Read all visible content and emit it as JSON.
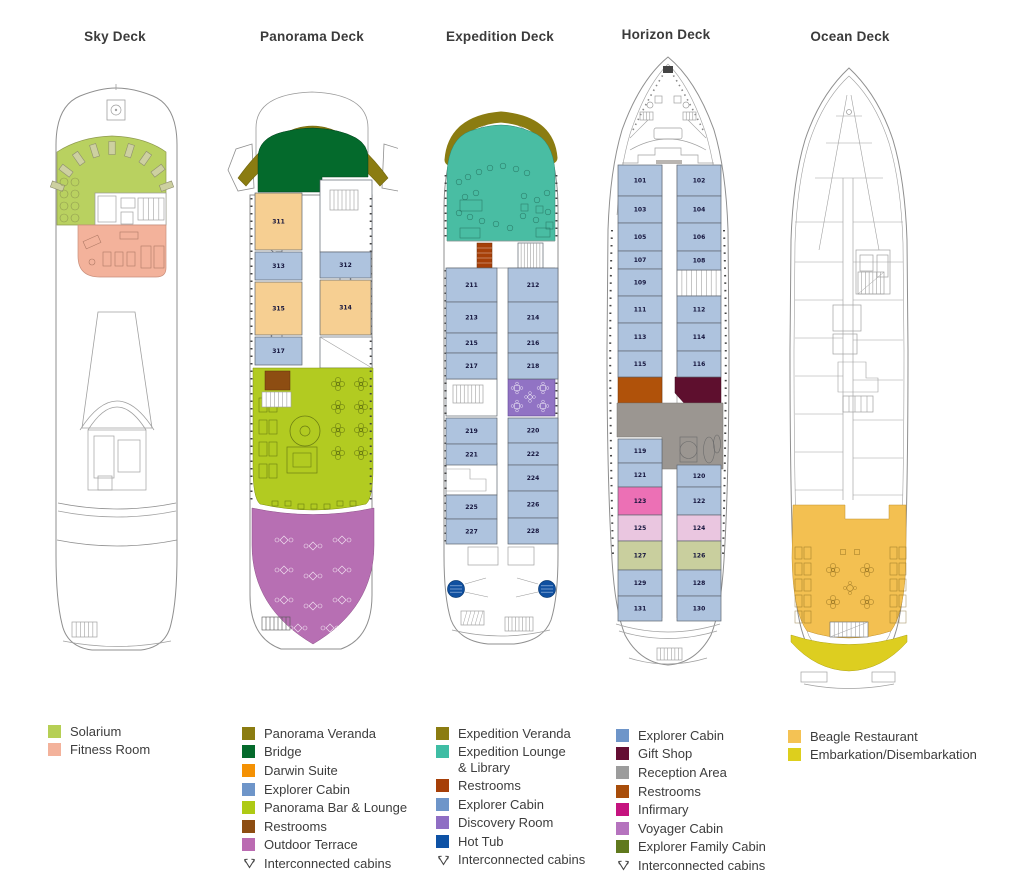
{
  "decks": [
    {
      "id": "sky",
      "title": "Sky Deck",
      "regions": {
        "solarium": "#b9d160",
        "fitness": "#f3b29b",
        "lounger": "#cdd0a0"
      },
      "legend": [
        {
          "label": "Solarium",
          "color": "#b6cf55"
        },
        {
          "label": "Fitness Room",
          "color": "#f3b29b"
        }
      ]
    },
    {
      "id": "panorama",
      "title": "Panorama Deck",
      "regions": {
        "veranda": "#8b7c11",
        "bridge": "#046a2c",
        "bar_lounge": "#b2cb21",
        "terrace": "#b76fb3",
        "restrooms": "#8d4d12"
      },
      "cabins": [
        {
          "number": "311",
          "fill": "#f6cf92"
        },
        {
          "number": "313",
          "fill": "#aec3de"
        },
        {
          "number": "315",
          "fill": "#f6cf92"
        },
        {
          "number": "317",
          "fill": "#aec3de"
        },
        {
          "number": "312",
          "fill": "#aec3de"
        },
        {
          "number": "314",
          "fill": "#f6cf92"
        }
      ],
      "legend": [
        {
          "label": "Panorama Veranda",
          "color": "#8b7c11"
        },
        {
          "label": "Bridge",
          "color": "#046a2c"
        },
        {
          "label": "Darwin Suite",
          "color": "#f49104"
        },
        {
          "label": "Explorer Cabin",
          "color": "#6e95c9"
        },
        {
          "label": "Panorama Bar & Lounge",
          "color": "#aeca14"
        },
        {
          "label": "Restrooms",
          "color": "#8d4d12"
        },
        {
          "label": "Outdoor Terrace",
          "color": "#bb6bb2"
        },
        {
          "label": "Interconnected cabins",
          "icon": "interconnect"
        }
      ]
    },
    {
      "id": "expedition",
      "title": "Expedition Deck",
      "regions": {
        "veranda": "#8b7c11",
        "lounge": "#49bda3",
        "restrooms": "#a63f08",
        "discovery": "#9173c4",
        "hot_tub": "#1050a0"
      },
      "cabins": [
        {
          "number": "211",
          "fill": "#aec3de"
        },
        {
          "number": "213",
          "fill": "#aec3de"
        },
        {
          "number": "215",
          "fill": "#aec3de"
        },
        {
          "number": "217",
          "fill": "#aec3de"
        },
        {
          "number": "219",
          "fill": "#aec3de"
        },
        {
          "number": "221",
          "fill": "#aec3de"
        },
        {
          "number": "225",
          "fill": "#aec3de"
        },
        {
          "number": "227",
          "fill": "#aec3de"
        },
        {
          "number": "212",
          "fill": "#aec3de"
        },
        {
          "number": "214",
          "fill": "#aec3de"
        },
        {
          "number": "216",
          "fill": "#aec3de"
        },
        {
          "number": "218",
          "fill": "#aec3de"
        },
        {
          "number": "220",
          "fill": "#aec3de"
        },
        {
          "number": "222",
          "fill": "#aec3de"
        },
        {
          "number": "224",
          "fill": "#aec3de"
        },
        {
          "number": "226",
          "fill": "#aec3de"
        },
        {
          "number": "228",
          "fill": "#aec3de"
        }
      ],
      "legend": [
        {
          "label": "Expedition Veranda",
          "color": "#8b7c11"
        },
        {
          "label": "Expedition Lounge",
          "label2": "& Library",
          "color": "#3fbda4"
        },
        {
          "label": "Restrooms",
          "color": "#a63f08"
        },
        {
          "label": "Explorer Cabin",
          "color": "#6e95c9"
        },
        {
          "label": "Discovery Room",
          "color": "#8f6ec4"
        },
        {
          "label": "Hot Tub",
          "color": "#0e52a5"
        },
        {
          "label": "Interconnected cabins",
          "icon": "interconnect"
        }
      ]
    },
    {
      "id": "horizon",
      "title": "Horizon Deck",
      "regions": {
        "restrooms": "#b0520a",
        "gift_shop": "#5e0f2e",
        "reception": "#9b9691"
      },
      "cabins": [
        {
          "number": "101",
          "fill": "#aec3de"
        },
        {
          "number": "103",
          "fill": "#aec3de"
        },
        {
          "number": "105",
          "fill": "#aec3de"
        },
        {
          "number": "107",
          "fill": "#aec3de"
        },
        {
          "number": "109",
          "fill": "#aec3de"
        },
        {
          "number": "111",
          "fill": "#aec3de"
        },
        {
          "number": "113",
          "fill": "#aec3de"
        },
        {
          "number": "115",
          "fill": "#aec3de"
        },
        {
          "number": "119",
          "fill": "#aec3de"
        },
        {
          "number": "121",
          "fill": "#aec3de"
        },
        {
          "number": "123",
          "fill": "#ec70b5"
        },
        {
          "number": "125",
          "fill": "#eac6e0"
        },
        {
          "number": "127",
          "fill": "#c9cf9e"
        },
        {
          "number": "129",
          "fill": "#aec3de"
        },
        {
          "number": "131",
          "fill": "#aec3de"
        },
        {
          "number": "102",
          "fill": "#aec3de"
        },
        {
          "number": "104",
          "fill": "#aec3de"
        },
        {
          "number": "106",
          "fill": "#aec3de"
        },
        {
          "number": "108",
          "fill": "#aec3de"
        },
        {
          "number": "112",
          "fill": "#aec3de"
        },
        {
          "number": "114",
          "fill": "#aec3de"
        },
        {
          "number": "116",
          "fill": "#aec3de"
        },
        {
          "number": "120",
          "fill": "#aec3de"
        },
        {
          "number": "122",
          "fill": "#aec3de"
        },
        {
          "number": "124",
          "fill": "#eac6e0"
        },
        {
          "number": "126",
          "fill": "#c9cf9e"
        },
        {
          "number": "128",
          "fill": "#aec3de"
        },
        {
          "number": "130",
          "fill": "#aec3de"
        }
      ],
      "legend": [
        {
          "label": "Explorer Cabin",
          "color": "#6e95c9"
        },
        {
          "label": "Gift Shop",
          "color": "#640e33"
        },
        {
          "label": "Reception Area",
          "color": "#9c9c9c"
        },
        {
          "label": "Restrooms",
          "color": "#a84d0a"
        },
        {
          "label": "Infirmary",
          "color": "#c5137f"
        },
        {
          "label": "Voyager Cabin",
          "color": "#b573be"
        },
        {
          "label": "Explorer Family Cabin",
          "color": "#60791d"
        },
        {
          "label": "Interconnected cabins",
          "icon": "interconnect"
        }
      ]
    },
    {
      "id": "ocean",
      "title": "Ocean Deck",
      "regions": {
        "restaurant": "#f3c051",
        "embarkation": "#ddce20"
      },
      "legend": [
        {
          "label": "Beagle Restaurant",
          "color": "#f4c254"
        },
        {
          "label": "Embarkation/Disembarkation",
          "color": "#ddcf1d"
        }
      ]
    }
  ]
}
